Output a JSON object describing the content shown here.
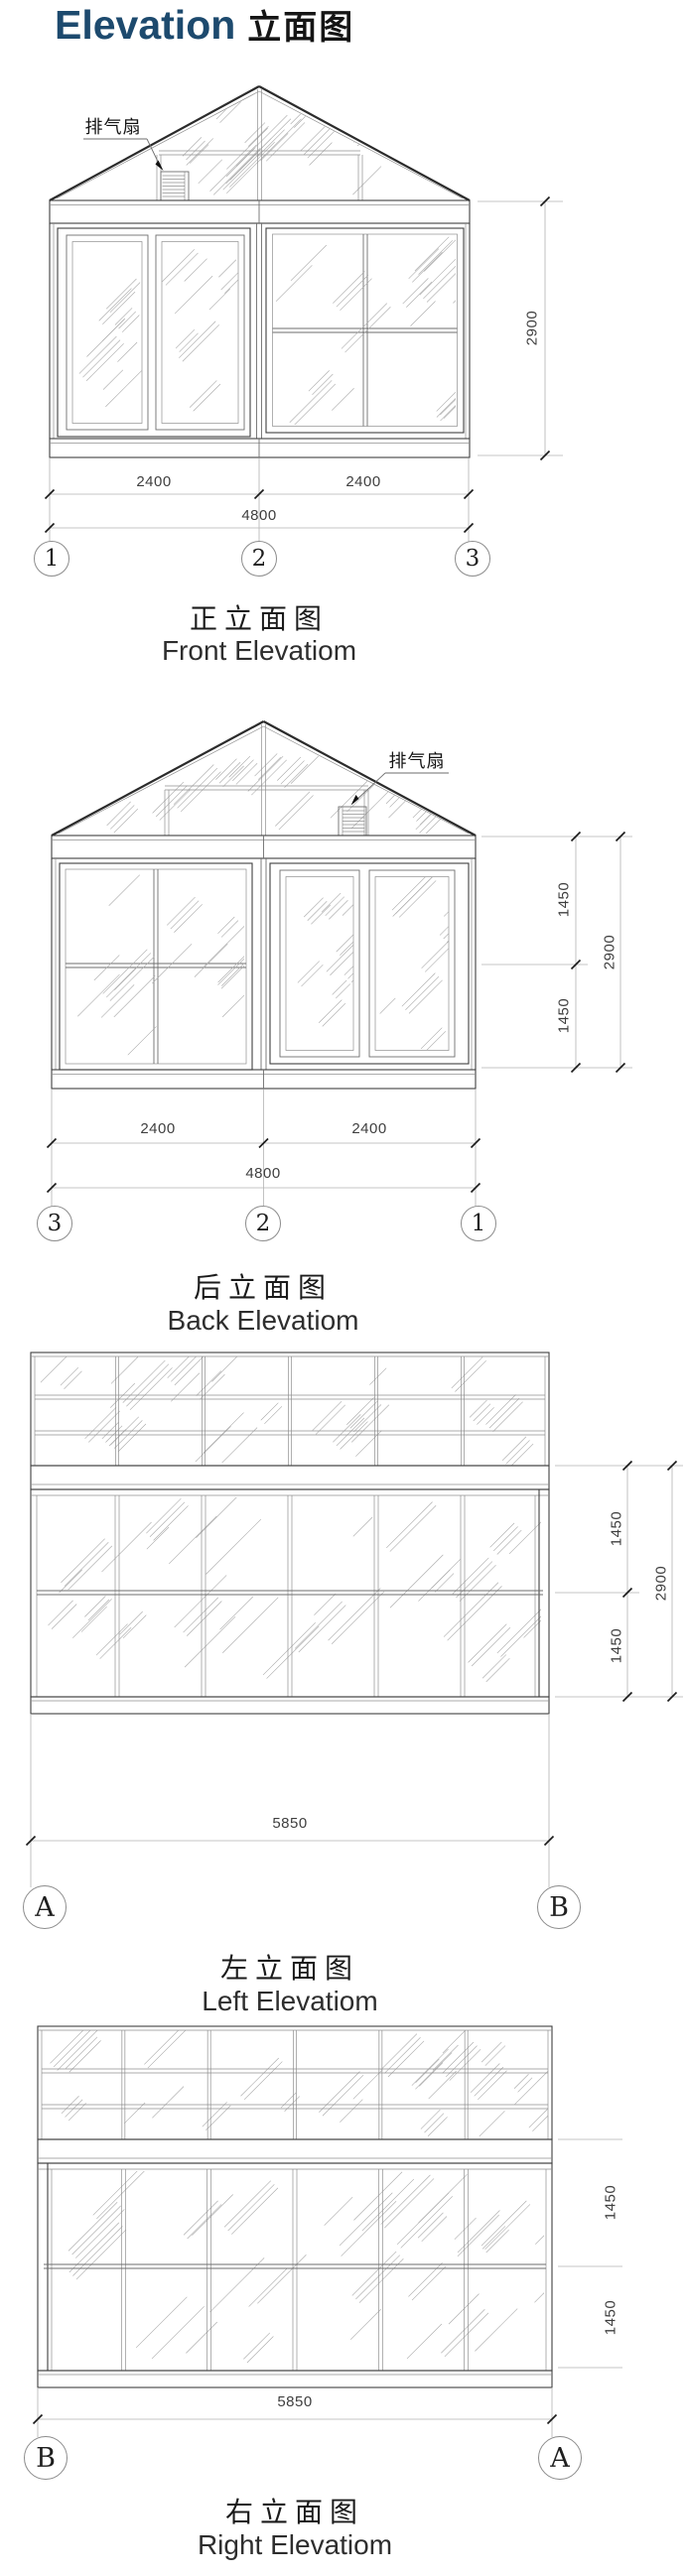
{
  "page_title": {
    "en": "Elevation",
    "zh": "立面图"
  },
  "colors": {
    "title_blue": "#1d4a6e",
    "drawing_line": "#3f3f3f",
    "hatch_line": "#a9a9a9",
    "dimension_line": "#b3b3b3"
  },
  "annotations": {
    "exhaust_fan_label": "排气扇"
  },
  "elevations": {
    "front": {
      "caption_zh": "正立面图",
      "caption_en": "Front Elevatiom",
      "axes": [
        "1",
        "2",
        "3"
      ],
      "width_dims": [
        "2400",
        "2400"
      ],
      "overall_width_dim": "4800",
      "height_dims": [],
      "overall_height_dim": "2900"
    },
    "back": {
      "caption_zh": "后立面图",
      "caption_en": "Back Elevatiom",
      "axes": [
        "3",
        "2",
        "1"
      ],
      "width_dims": [
        "2400",
        "2400"
      ],
      "overall_width_dim": "4800",
      "height_dims": [
        "1450",
        "1450"
      ],
      "overall_height_dim": "2900"
    },
    "left": {
      "caption_zh": "左立面图",
      "caption_en": "Left Elevatiom",
      "axes": [
        "A",
        "B"
      ],
      "width_dims": [],
      "overall_width_dim": "5850",
      "height_dims": [
        "1450",
        "1450"
      ],
      "overall_height_dim": "2900"
    },
    "right": {
      "caption_zh": "右立面图",
      "caption_en": "Right Elevatiom",
      "axes": [
        "B",
        "A"
      ],
      "width_dims": [],
      "overall_width_dim": "5850",
      "height_dims": [
        "1450",
        "1450"
      ]
    }
  }
}
